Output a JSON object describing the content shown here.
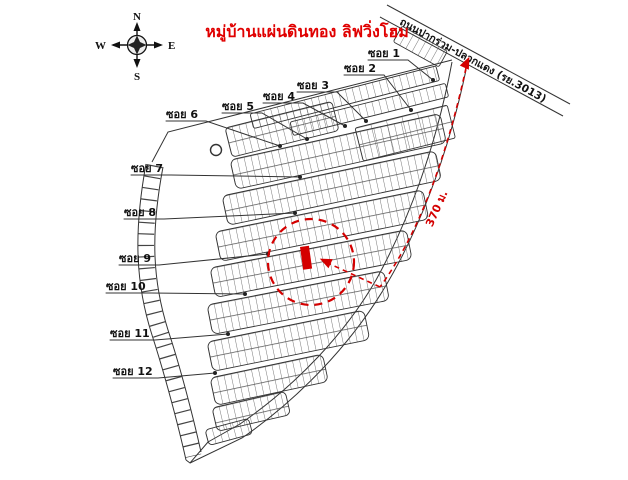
{
  "title": "หมู่บ้านแผ่นดินทอง ลิฟวิ่งโฮม",
  "road": {
    "name": "ถนนปากร่วม-ปลวกแดง (รย.3013)"
  },
  "measurement": {
    "distance": "370 ม."
  },
  "compass": {
    "north": "N",
    "south": "S",
    "east": "E",
    "west": "W"
  },
  "sois": [
    {
      "label": "ซอย 1"
    },
    {
      "label": "ซอย 2"
    },
    {
      "label": "ซอย 3"
    },
    {
      "label": "ซอย 4"
    },
    {
      "label": "ซอย 5"
    },
    {
      "label": "ซอย 6"
    },
    {
      "label": "ซอย 7"
    },
    {
      "label": "ซอย 8"
    },
    {
      "label": "ซอย 9"
    },
    {
      "label": "ซอย 10"
    },
    {
      "label": "ซอย 11"
    },
    {
      "label": "ซอย 12"
    }
  ],
  "colors": {
    "accent": "#d40000",
    "line": "#333333"
  }
}
